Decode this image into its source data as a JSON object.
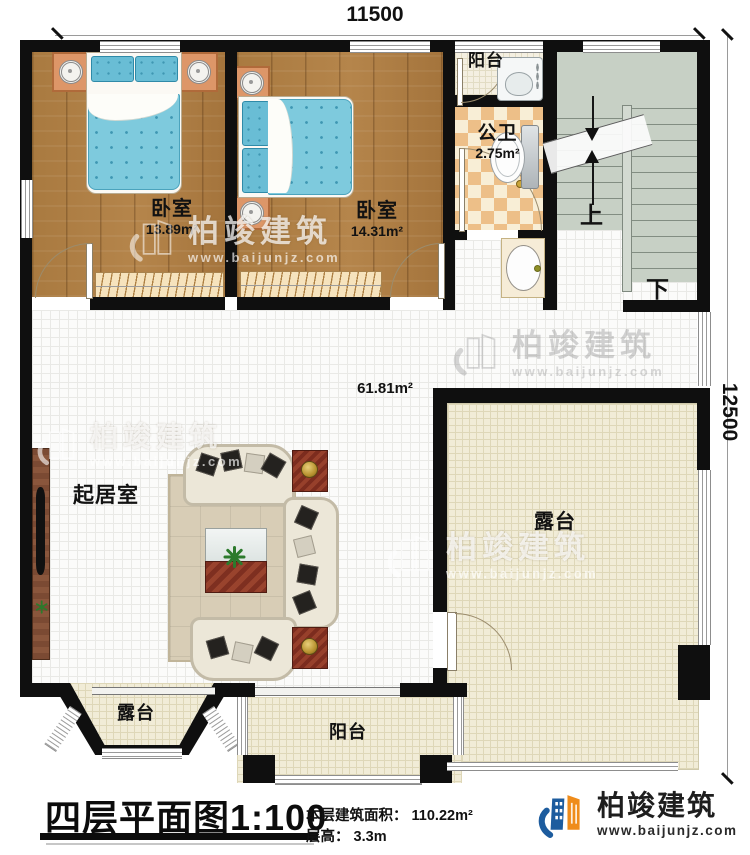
{
  "dimensions": {
    "top": "11500",
    "right": "12500"
  },
  "rooms": {
    "bedroom_left": {
      "label": "卧室",
      "area": "13.89m²"
    },
    "bedroom_right": {
      "label": "卧室",
      "area": "14.31m²"
    },
    "bathroom": {
      "label": "公卫",
      "area": "2.75m²"
    },
    "balcony_top": {
      "label": "阳台"
    },
    "living_room": {
      "label": "起居室",
      "area": "61.81m²"
    },
    "terrace_right": {
      "label": "露台"
    },
    "terrace_bottom_left": {
      "label": "露台"
    },
    "balcony_bottom": {
      "label": "阳台"
    },
    "stairs": {
      "up": "上",
      "down": "下"
    }
  },
  "footer": {
    "title": "四层平面图",
    "scale": "1:100",
    "area_label": "本层建筑面积：",
    "area_value": "110.22m²",
    "height_label": "层高：",
    "height_value": "3.3m"
  },
  "brand": {
    "name": "柏竣建筑",
    "site": "www.baijunjz.com"
  }
}
